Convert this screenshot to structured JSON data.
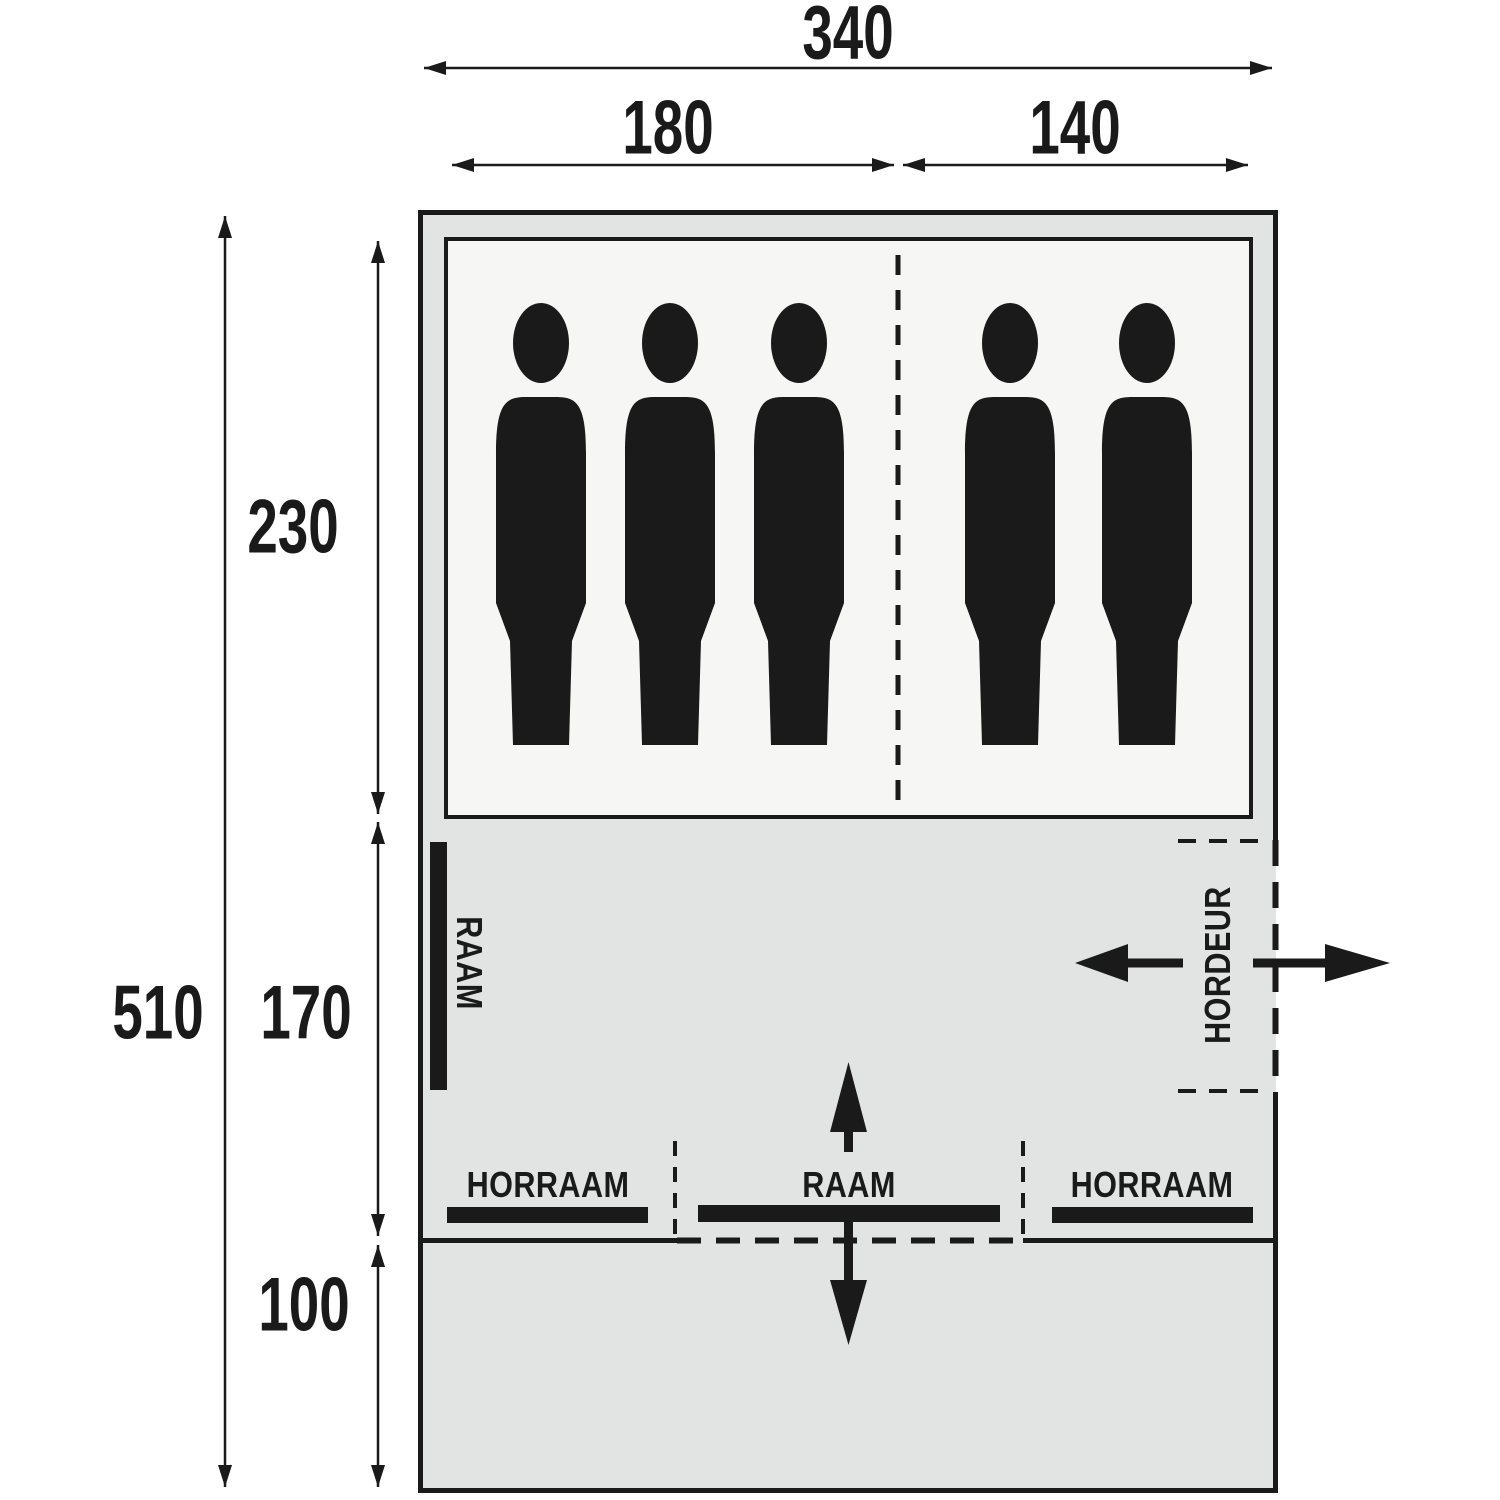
{
  "floorplan": {
    "kind": "tent-floorplan-top-view",
    "unit": "cm",
    "total_width": "340",
    "total_depth": "510",
    "sleeping": {
      "left_width": "180",
      "right_width": "140",
      "depth": "230",
      "persons_left": 3,
      "persons_right": 2,
      "persons_total": 5
    },
    "living_depth": "170",
    "canopy_depth": "100",
    "features": {
      "left_window": "RAAM",
      "screen_door": "HORDEUR",
      "left_screen_window": "HORRAAM",
      "front_window": "RAAM",
      "right_screen_window": "HORRAAM"
    },
    "colors": {
      "line": "#1a1a1a",
      "tent_fill": "#e2e4e3",
      "sleeping_fill": "#f6f6f4",
      "background": "#ffffff"
    }
  }
}
